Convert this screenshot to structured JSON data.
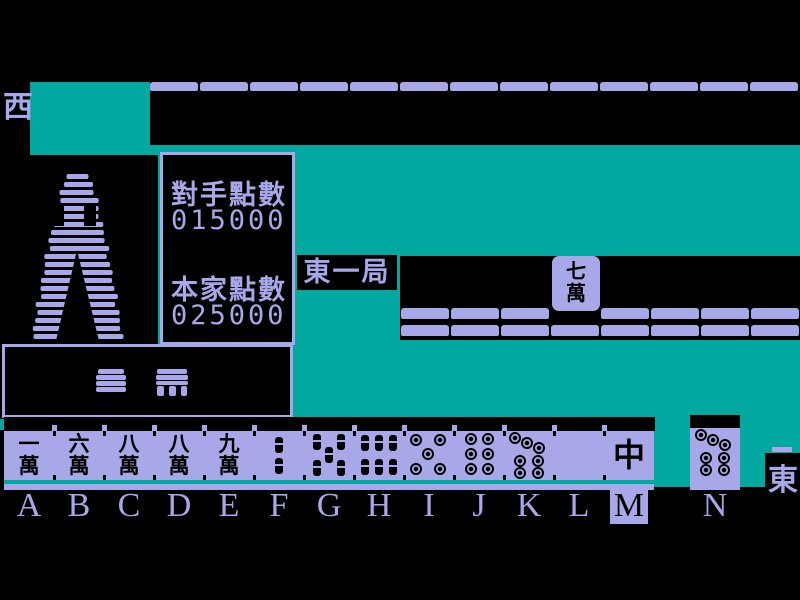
{
  "colors": {
    "teal": "#00a8a0",
    "lavender": "#a8a8e8",
    "ink": "#000000"
  },
  "opponent": {
    "seat_wind": "西",
    "wall_tile_count": 13
  },
  "round": {
    "label": "東一局"
  },
  "scoreboard": {
    "opponent_label": "對手點數",
    "opponent_points": "015000",
    "self_label": "本家點數",
    "self_points": "025000"
  },
  "discard": {
    "tile": {
      "name": "7-man",
      "chars": [
        "七",
        "萬"
      ]
    },
    "rows": [
      {
        "left_count": 3,
        "right_count": 4
      },
      {
        "count": 8
      }
    ]
  },
  "player": {
    "seat_wind": "東",
    "selected_slot": "M"
  },
  "hand": {
    "slots": [
      {
        "letter": "A",
        "name": "1-man",
        "type": "man",
        "chars": [
          "一",
          "萬"
        ]
      },
      {
        "letter": "B",
        "name": "6-man",
        "type": "man",
        "chars": [
          "六",
          "萬"
        ]
      },
      {
        "letter": "C",
        "name": "8-man",
        "type": "man",
        "chars": [
          "八",
          "萬"
        ]
      },
      {
        "letter": "D",
        "name": "8-man",
        "type": "man",
        "chars": [
          "八",
          "萬"
        ]
      },
      {
        "letter": "E",
        "name": "9-man",
        "type": "man",
        "chars": [
          "九",
          "萬"
        ]
      },
      {
        "letter": "F",
        "name": "2-sou",
        "type": "sou",
        "count": 2
      },
      {
        "letter": "G",
        "name": "5-sou",
        "type": "sou",
        "count": 5
      },
      {
        "letter": "H",
        "name": "6-sou",
        "type": "sou",
        "count": 6
      },
      {
        "letter": "I",
        "name": "5-pin",
        "type": "pin",
        "count": 5
      },
      {
        "letter": "J",
        "name": "6-pin",
        "type": "pin",
        "count": 6
      },
      {
        "letter": "K",
        "name": "7-pin",
        "type": "pin",
        "count": 7
      },
      {
        "letter": "L",
        "name": "white-dragon",
        "type": "blank"
      },
      {
        "letter": "M",
        "name": "red-dragon",
        "type": "honor",
        "chars": [
          "中"
        ]
      }
    ],
    "drawn": {
      "letter": "N",
      "name": "7-pin",
      "type": "pin",
      "count": 7
    }
  }
}
